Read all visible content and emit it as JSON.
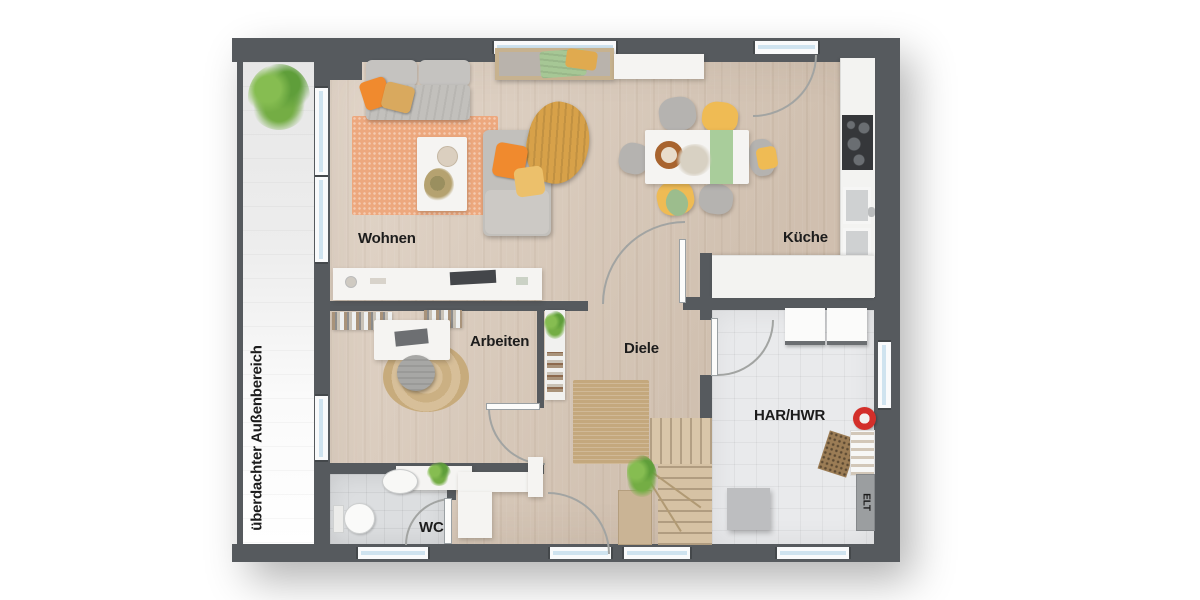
{
  "labels": {
    "wohnen": "Wohnen",
    "kueche": "Küche",
    "arbeiten": "Arbeiten",
    "diele": "Diele",
    "har_hwr": "HAR/HWR",
    "wc": "WC",
    "elt": "ELT",
    "outdoor": "überdachter Außenbereich"
  },
  "colors": {
    "wall": "#565a5e",
    "floor-wood": "#d8c7b6",
    "floor-tile": "#e9eaec",
    "floor-tile-dark": "#dcdee0",
    "glass": "#cfe3ef",
    "frame": "#f9fafb",
    "rug-coral": "#eda87e",
    "rug-jute": "#c4a87d",
    "accent-orange": "#f08a2e",
    "accent-mustard": "#d7a149",
    "accent-yellow": "#efbb54",
    "accent-green": "#a6c795",
    "sofa-gray": "#c2c0bc",
    "furn-white": "#f5f4f2",
    "stair-wood": "#d9c6a9",
    "line": "#a2a4a2",
    "accent-red": "#d32f2a",
    "label": "#1c1c1c"
  }
}
